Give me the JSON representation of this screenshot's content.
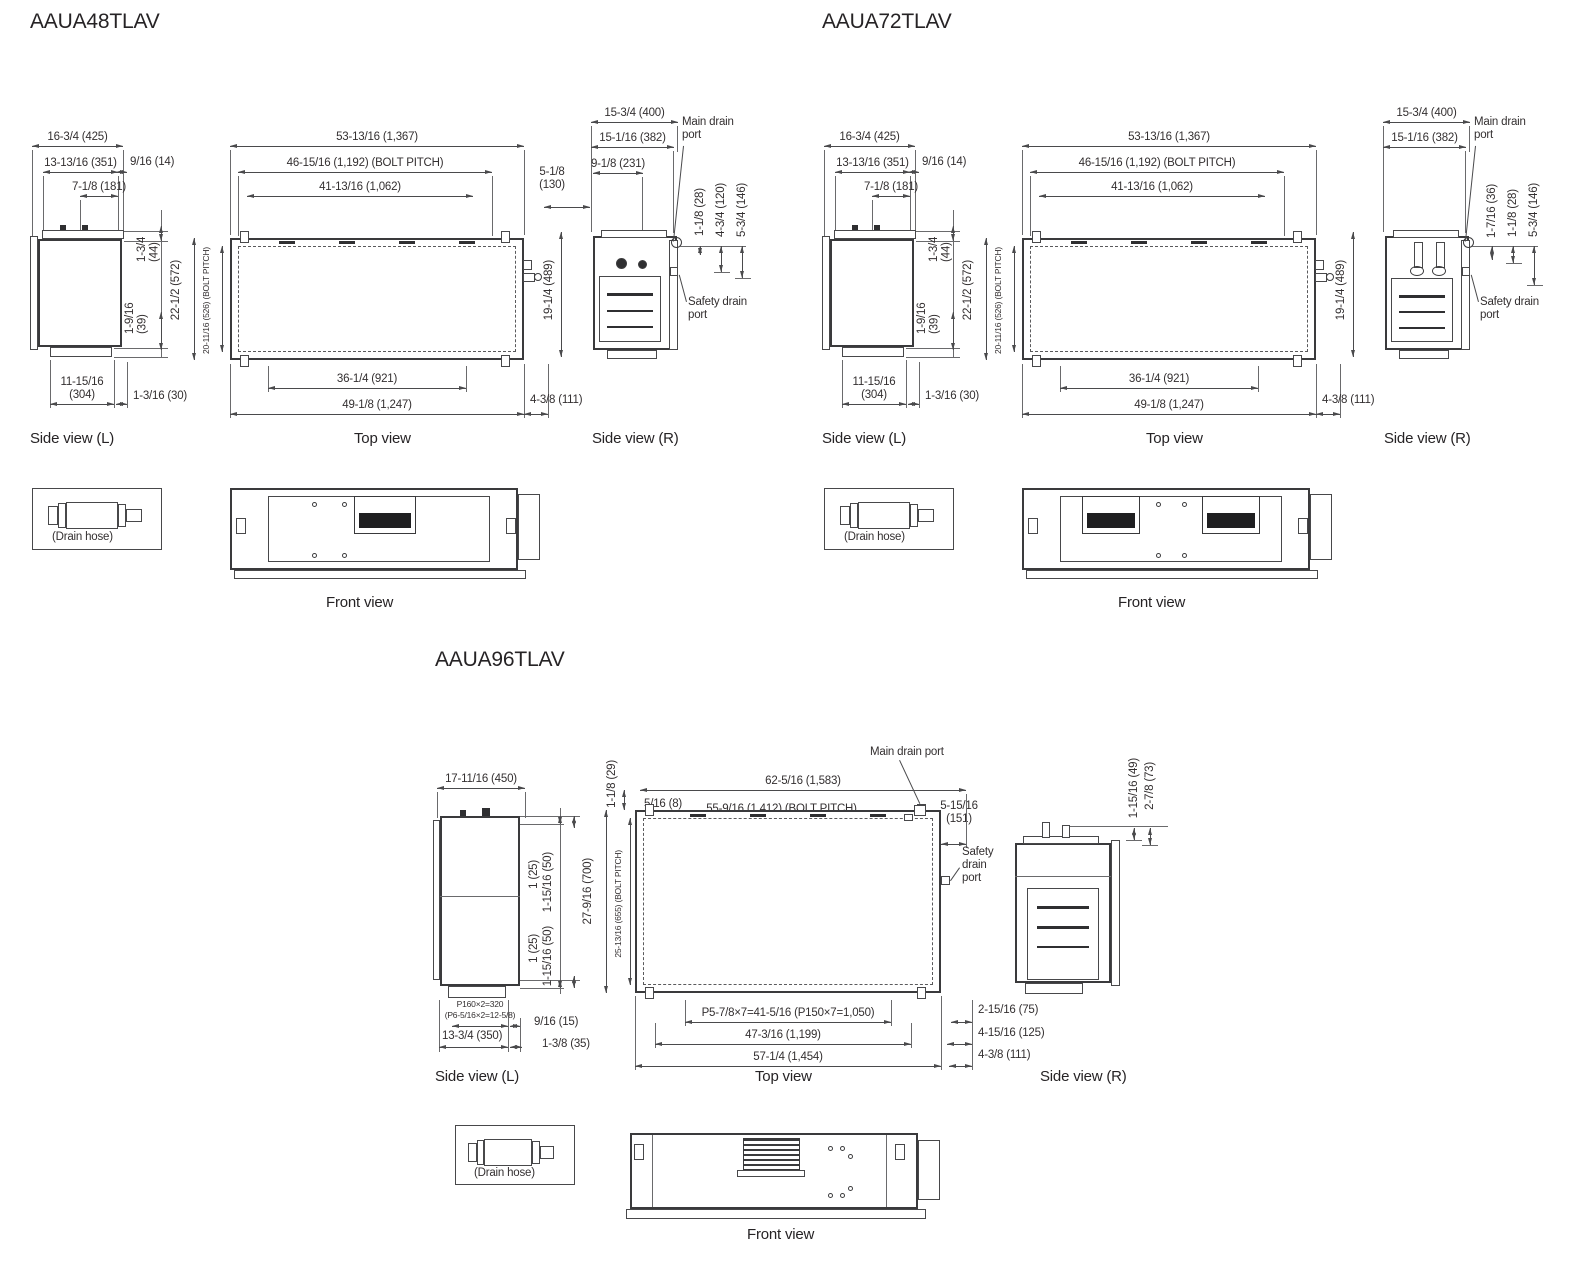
{
  "labels": {
    "side_l": "Side view (L)",
    "top": "Top view",
    "side_r": "Side view (R)",
    "front": "Front view",
    "drain_hose": "(Drain hose)",
    "main_drain": "Main drain port",
    "safety_drain": "Safety drain port"
  },
  "m48": {
    "title": "AAUA48TLAV",
    "side_l": {
      "w_outer": "16-3/4 (425)",
      "w_mid": "13-13/16 (351)",
      "w_inner": "7-1/8 (181)",
      "offset_top": "9/16 (14)",
      "h_top": "1-3/4 (44)",
      "h_mid": "1-9/16 (39)",
      "w_bottom": "11-15/16 (304)",
      "offset_bottom": "1-3/16 (30)"
    },
    "top": {
      "w_outer": "53-13/16 (1,367)",
      "w_bolt": "46-15/16 (1,192) (BOLT PITCH)",
      "w_inner": "41-13/16 (1,062)",
      "d_outer": "22-1/2 (572)",
      "d_bolt": "20-11/16 (526) (BOLT PITCH)",
      "w_flange": "36-1/4 (921)",
      "w_base": "49-1/8 (1,247)",
      "offset_right": "4-3/8 (111)"
    },
    "side_r": {
      "w_outer": "15-3/4 (400)",
      "w_mid": "15-1/16 (382)",
      "w_port": "9-1/8 (231)",
      "offset_left": "5-1/8 (130)",
      "h_unit": "19-1/4 (489)",
      "v1": "1-1/8 (28)",
      "v2": "4-3/4 (120)",
      "v3": "5-3/4 (146)"
    }
  },
  "m72": {
    "title": "AAUA72TLAV",
    "side_l": {
      "w_outer": "16-3/4 (425)",
      "w_mid": "13-13/16 (351)",
      "w_inner": "7-1/8 (181)",
      "offset_top": "9/16 (14)",
      "h_top": "1-3/4 (44)",
      "h_mid": "1-9/16 (39)",
      "w_bottom": "11-15/16 (304)",
      "offset_bottom": "1-3/16 (30)"
    },
    "top": {
      "w_outer": "53-13/16 (1,367)",
      "w_bolt": "46-15/16 (1,192) (BOLT PITCH)",
      "w_inner": "41-13/16 (1,062)",
      "d_outer": "22-1/2 (572)",
      "d_bolt": "20-11/16 (526) (BOLT PITCH)",
      "w_flange": "36-1/4 (921)",
      "w_base": "49-1/8 (1,247)",
      "offset_right": "4-3/8 (111)"
    },
    "side_r": {
      "w_outer": "15-3/4 (400)",
      "w_mid": "15-1/16 (382)",
      "h_unit": "19-1/4 (489)",
      "v1": "1-7/16 (36)",
      "v2": "1-1/8 (28)",
      "v3": "5-3/4 (146)"
    }
  },
  "m96": {
    "title": "AAUA96TLAV",
    "side_l": {
      "w_outer": "17-11/16 (450)",
      "v1a": "1 (25)",
      "v1b": "1-15/16 (50)",
      "v2a": "1 (25)",
      "v2b": "1-15/16 (50)",
      "pitch_a": "P160×2=320",
      "pitch_b": "(P6-5/16×2=12-5/8)",
      "w_bottom": "13-3/4 (350)",
      "offset_a": "9/16 (15)",
      "offset_b": "1-3/8 (35)"
    },
    "top": {
      "w_outer": "62-5/16 (1,583)",
      "offset_left_sm": "5/16 (8)",
      "w_bolt": "55-9/16 (1,412) (BOLT PITCH)",
      "w_inner": "49-1/4 (1,251)",
      "v_top": "1-1/8 (29)",
      "d_outer": "27-9/16 (700)",
      "d_bolt": "25-13/16 (655) (BOLT PITCH)",
      "offset_right_top": "5-15/16 (151)",
      "w_pitch": "P5-7/8×7=41-5/16 (P150×7=1,050)",
      "w_flange": "47-3/16 (1,199)",
      "w_base": "57-1/4 (1,454)",
      "r1": "2-15/16 (75)",
      "r2": "4-15/16 (125)",
      "r3": "4-3/8 (111)"
    },
    "side_r": {
      "v1": "1-15/16 (49)",
      "v2": "2-7/8 (73)"
    }
  }
}
